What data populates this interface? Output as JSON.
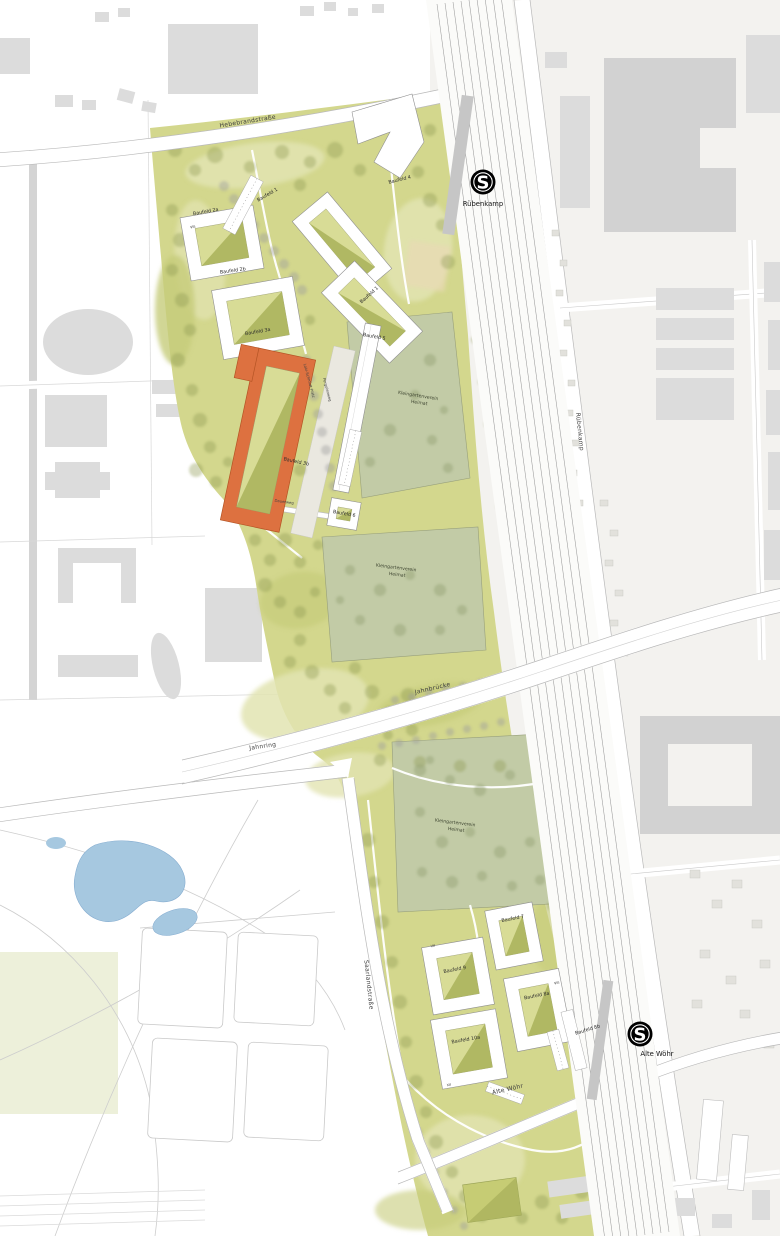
{
  "plan": {
    "stations": [
      {
        "logo": "S",
        "name": "Rübenkamp"
      },
      {
        "logo": "S",
        "name": "Alte Wöhr"
      }
    ],
    "streets": {
      "hebebrandstrasse": "Hebebrandstraße",
      "ruebenkamp": "Rübenkamp",
      "jahnbruecke": "Jahnbrücke",
      "jahnring": "Jahnring",
      "saarlandstrasse": "Saarlandstraße",
      "alte_woehr": "Alte Wöhr",
      "loki_schmidt_platz": "Loki-Schmidt-Platz",
      "pergolenweg": "Pergolenweg",
      "dauerweg": "Dauerweg"
    },
    "baufelder": {
      "bf1a": "Baufeld 1",
      "bf1b": "Baufeld 1",
      "bf2a": "Baufeld 2a",
      "bf2b": "Baufeld 2b",
      "bf3a": "Baufeld 3a",
      "bf3b": "Baufeld 3b",
      "bf4": "Baufeld 4",
      "bf5": "Baufeld 5",
      "bf6": "Baufeld 6",
      "bf7": "Baufeld 7",
      "bf8a": "Baufeld 8a",
      "bf8b": "Baufeld 8b",
      "bf9": "Baufeld 9",
      "bf10a": "Baufeld 10a"
    },
    "allotments": {
      "line1": "Kleingartenverein",
      "line2": "Heimat"
    },
    "storeys": {
      "bf2": "VIII",
      "bf9": "VII",
      "bf8a": "VIII",
      "bf10a": "XII"
    },
    "colors": {
      "site_green": "#d3d78d",
      "courtyard_green": "#a9b25b",
      "allotment_green": "#c2cba6",
      "accent_orange": "#dd7140",
      "water_blue": "#a6c8e0",
      "building_gray": "#dcdcdc",
      "station_black": "#000000"
    }
  }
}
